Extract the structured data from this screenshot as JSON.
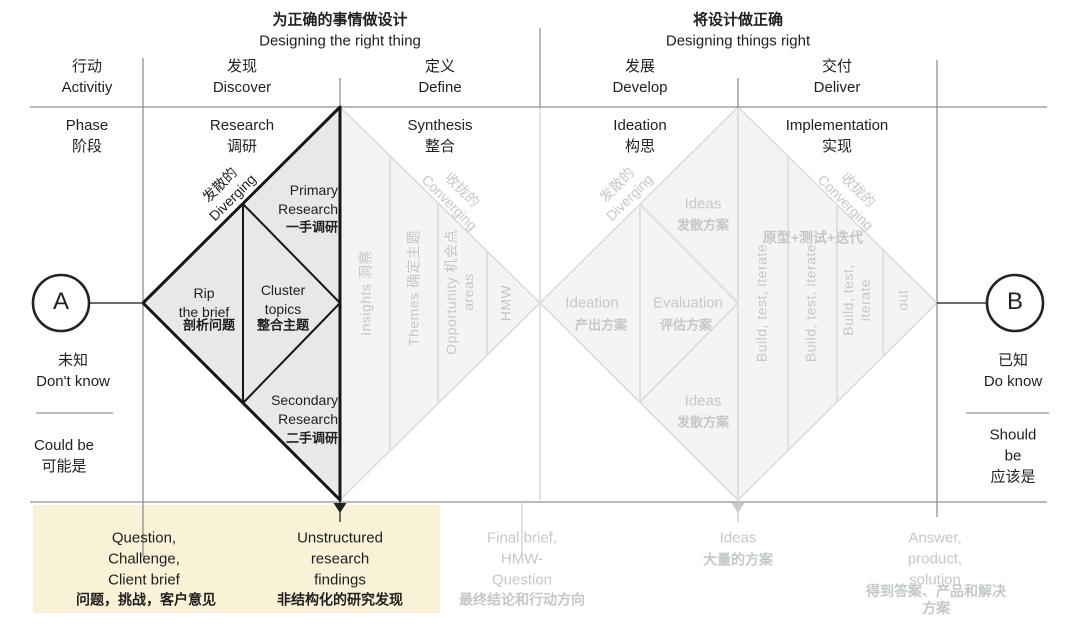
{
  "colors": {
    "ink": "#1f1f1f",
    "grid": "#8d9192",
    "faded_text": "#c4c8c9",
    "faded_stroke": "#dbdddd",
    "faded_fill": "#f3f4f4",
    "dark_fill": "#e7e9e9",
    "dark_stroke": "#161616",
    "highlight_bg": "#f9f2d7"
  },
  "header": {
    "left_zh": "为正确的事情做设计",
    "left_en": "Designing the right thing",
    "right_zh": "将设计做正确",
    "right_en": "Designing things right"
  },
  "columns": {
    "activity": "行动\nActivitiy",
    "discover": "发现\nDiscover",
    "define": "定义\nDefine",
    "develop": "发展\nDevelop",
    "deliver": "交付\nDeliver"
  },
  "phases": {
    "label": "Phase\n阶段",
    "research": "Research\n调研",
    "synthesis": "Synthesis\n整合",
    "ideation": "Ideation\n构思",
    "implementation": "Implementation\n实现"
  },
  "endpoint_a": {
    "letter": "A",
    "know": "未知\nDon't know",
    "mode": "Could be\n可能是"
  },
  "endpoint_b": {
    "letter": "B",
    "know": "已知\nDo know",
    "mode": "Should be\n应该是"
  },
  "diamond1": {
    "diverging": "发散的\nDiverging",
    "converging": "收拢的\nConverging",
    "primary_en": "Primary\nResearch",
    "primary_zh": "一手调研",
    "rip_en": "Rip\nthe brief",
    "rip_zh": "剖析问题",
    "cluster_en": "Cluster\ntopics",
    "cluster_zh": "整合主题",
    "secondary_en": "Secondary\nResearch",
    "secondary_zh": "二手调研",
    "col_insights": "Insights 洞察",
    "col_themes": "Themes 确定主题",
    "col_opportunity": "Opportunity 机会点\nareas",
    "col_hmw": "HMW"
  },
  "diamond2": {
    "diverging": "发散的\nDiverging",
    "converging": "收拢的\nConverging",
    "ideas_top_en": "Ideas",
    "ideas_top_zh": "发散方案",
    "ideation_en": "Ideation",
    "ideation_zh": "产出方案",
    "evaluation_en": "Evaluation",
    "evaluation_zh": "评估方案",
    "ideas_bottom_en": "Ideas",
    "ideas_bottom_zh": "发散方案",
    "prototype_zh": "原型+测试+迭代",
    "col_build_1": "Build, test, iterate",
    "col_build_2": "Build, test, iterate",
    "col_build_3": "Build, test,\niterate",
    "col_out": "out"
  },
  "outputs": {
    "question_en": "Question,\nChallenge,\nClient brief",
    "question_zh": "问题，挑战，客户意见",
    "unstructured_en": "Unstructured\nresearch\nfindings",
    "unstructured_zh": "非结构化的研究发现",
    "final_brief_en": "Final brief,\nHMW-\nQuestion",
    "final_brief_zh": "最终结论和行动方向",
    "ideas_en": "Ideas",
    "ideas_zh": "大量的方案",
    "answer_en": "Answer,\nproduct,\nsolution",
    "answer_zh": "得到答案、产品和解决方案"
  }
}
